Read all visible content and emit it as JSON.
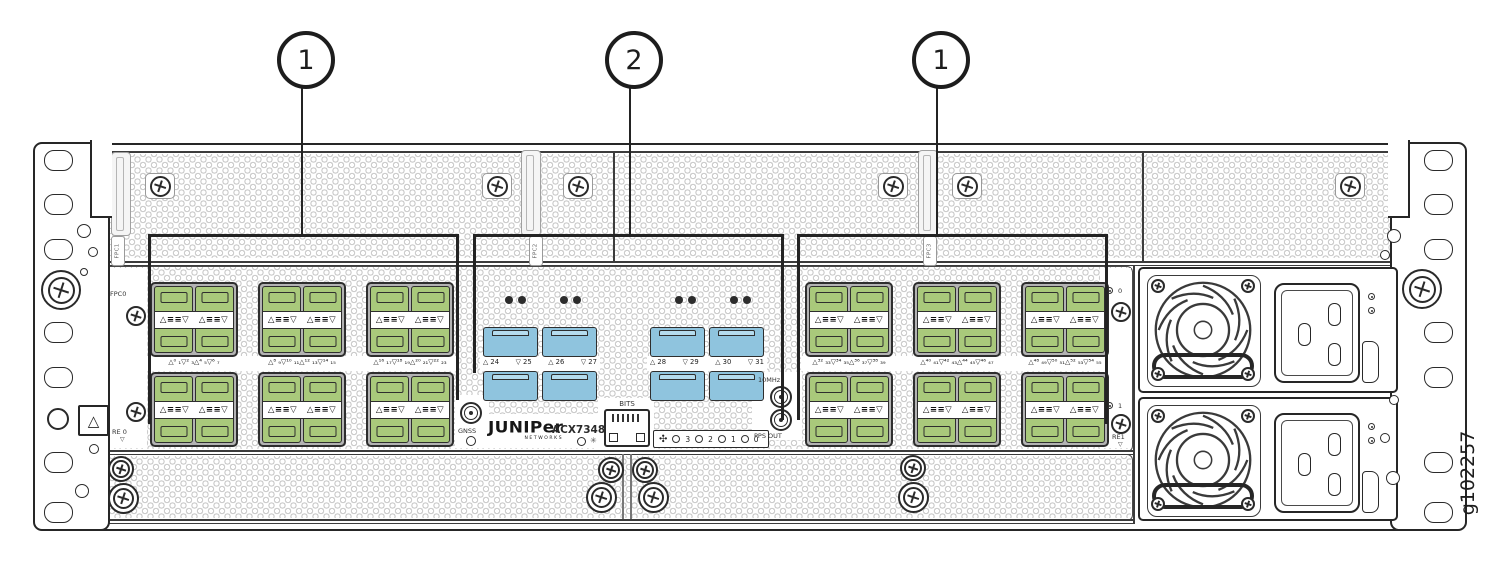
{
  "figure": {
    "id_label": "g102257"
  },
  "callouts": {
    "items": [
      {
        "label": "1"
      },
      {
        "label": "2"
      },
      {
        "label": "1"
      }
    ]
  },
  "top_row": {
    "slot_tags": [
      "FPC1",
      "FPC2",
      "FPC3"
    ]
  },
  "side_labels": {
    "fpc0": "FPC0",
    "re0": "RE 0",
    "re0_arrow": "▽",
    "psu0_index": "0",
    "psu1_index": "1",
    "re1": "RE1",
    "re1_arrow": "▽"
  },
  "center": {
    "gnss_label": "GNSS",
    "bits_label": "BITS",
    "mhz_label": "10MHz",
    "pps_label": "PPS OUT",
    "brand_logo": "JUNIPer",
    "brand_sub": "NETWORKS",
    "model": "ACX7348",
    "model_led_symbol": "✳",
    "fan_icon_symbol": "✣",
    "fan_led_labels": [
      "3",
      "2",
      "1",
      "0"
    ]
  },
  "ports": {
    "cage_symbol": "△≡≡▽",
    "left_captions": [
      "△⁰ ₁▽² ₃△⁴ ₅▽⁶ ₇",
      "△⁸ ₉▽¹⁰ ₁₁△¹² ₁₃▽¹⁴ ₁₅",
      "△¹⁶ ₁₇▽¹⁸ ₁₉△²⁰ ₂₁▽²² ₂₃"
    ],
    "center_captions": [
      [
        "△ 24",
        "▽ 25",
        "△ 26",
        "▽ 27"
      ],
      [
        "△ 28",
        "▽ 29",
        "△ 30",
        "▽ 31"
      ]
    ],
    "right_captions": [
      "△³² ₃₃▽³⁴ ₃₅△³⁶ ₃₇▽³⁸ ₃₉",
      "△⁴⁰ ₄₁▽⁴² ₄₃△⁴⁴ ₄₅▽⁴⁶ ₄₇",
      "△⁴⁸ ₄₉▽⁵⁰ ₅₁△⁵² ₅₃▽⁵⁴ ₅₅"
    ]
  },
  "colors": {
    "port_green": "#a9c97b",
    "port_blue": "#8fc4de",
    "line_dark": "#2b2b2b"
  }
}
